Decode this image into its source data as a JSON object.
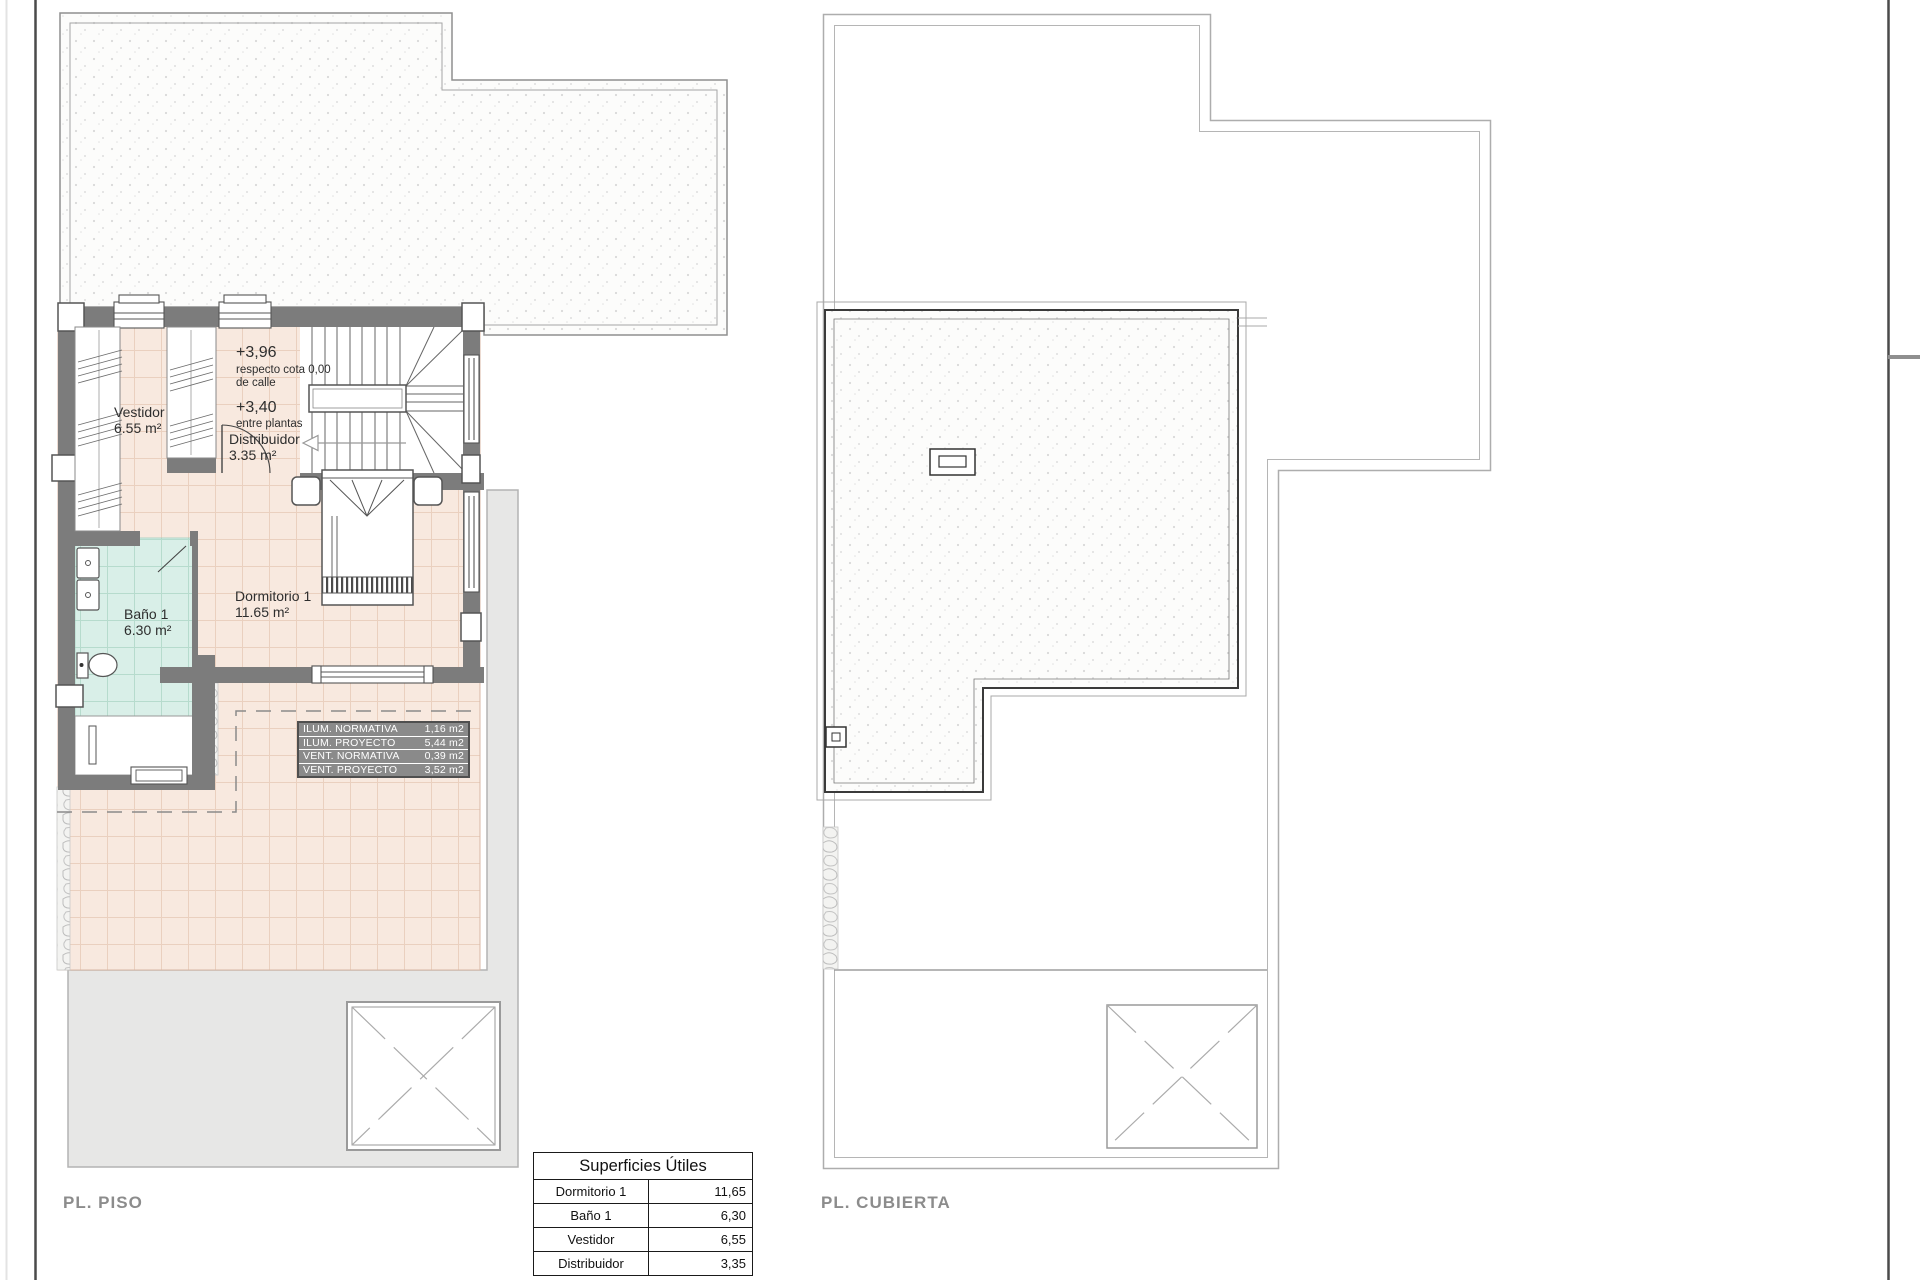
{
  "floor_plan": {
    "label": "PL. PISO",
    "rooms": {
      "vestidor": {
        "name": "Vestidor",
        "area": "6.55 m²"
      },
      "bano": {
        "name": "Baño 1",
        "area": "6.30 m²"
      },
      "dormitorio": {
        "name": "Dormitorio 1",
        "area": "11.65 m²"
      },
      "distribuidor": {
        "name": "Distribuidor",
        "area": "3.35 m²"
      }
    },
    "levels": {
      "upper": "+3,96",
      "upper_note1": "respecto cota 0,00",
      "upper_note2": "de calle",
      "mid": "+3,40",
      "mid_note": "entre plantas"
    },
    "lighting_table": {
      "rows": [
        {
          "label": "ILUM. NORMATIVA",
          "value": "1,16 m2"
        },
        {
          "label": "ILUM. PROYECTO",
          "value": "5,44 m2"
        },
        {
          "label": "VENT. NORMATIVA",
          "value": "0,39 m2"
        },
        {
          "label": "VENT. PROYECTO",
          "value": "3,52 m2"
        }
      ]
    }
  },
  "roof_plan": {
    "label": "PL. CUBIERTA"
  },
  "surfaces_table": {
    "title": "Superficies Útiles",
    "rows": [
      {
        "label": "Dormitorio 1",
        "value": "11,65"
      },
      {
        "label": "Baño 1",
        "value": "6,30"
      },
      {
        "label": "Vestidor",
        "value": "6,55"
      },
      {
        "label": "Distribuidor",
        "value": "3,35"
      }
    ]
  },
  "colors": {
    "wall": "#7c7c7c",
    "tile_floor": "#f8e9df",
    "bath_floor": "#d9efe8",
    "ground": "#e7e7e6",
    "table_bg": "#8a8a8a"
  }
}
